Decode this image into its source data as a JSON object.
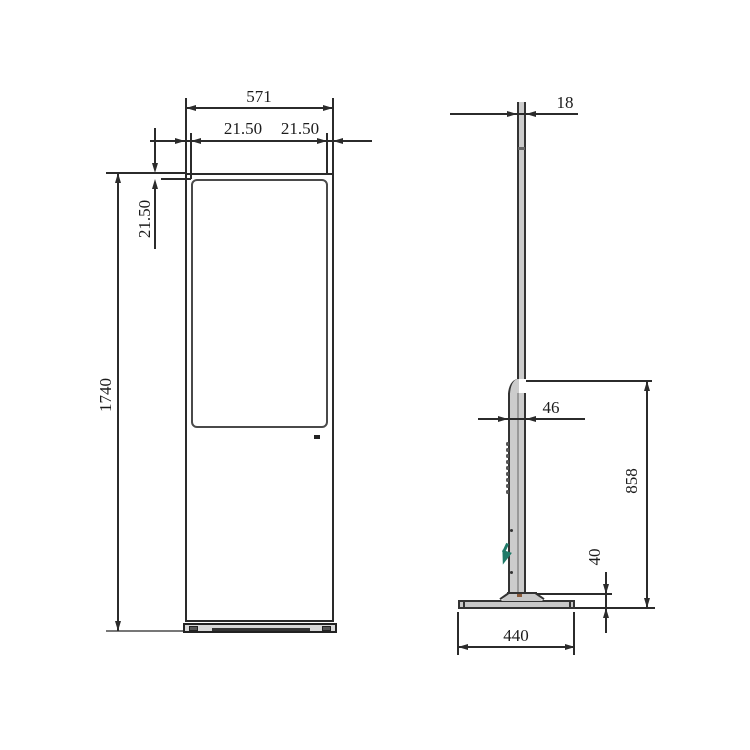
{
  "drawing": {
    "front_view": {
      "dims": {
        "overall_width": "571",
        "bezel_left": "21.50",
        "bezel_right": "21.50",
        "bezel_top": "21.50",
        "overall_height": "1740"
      }
    },
    "side_view": {
      "dims": {
        "top_thickness": "18",
        "body_thickness": "46",
        "panel_height": "858",
        "base_height": "40",
        "base_depth": "440"
      }
    },
    "colors": {
      "line": "#2b2b2b",
      "metal_fill": "#cccccc",
      "base_fill": "#c8c8c8",
      "accent_green": "#1e7a68"
    }
  }
}
